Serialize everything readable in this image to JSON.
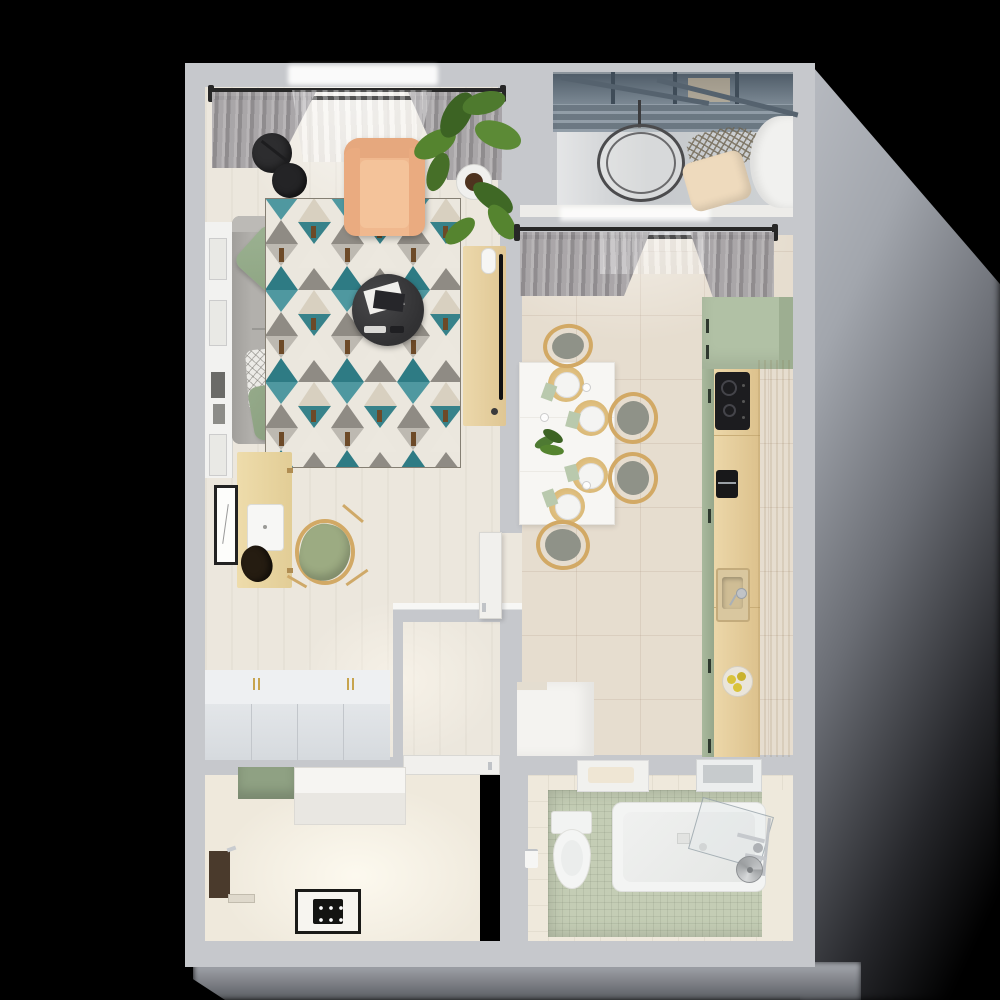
{
  "scene": {
    "title": "Top-down 3D render of a one-bedroom apartment floor plan",
    "view": "top-down interior render",
    "background_color": "#000000",
    "lighting": "daylight from upper-left; soft gray shadow cast to the right and below the outer walls"
  },
  "palette": {
    "bg": "#000000",
    "wall": "#c6c8cc",
    "rod": "#272727",
    "floorLiving": "#ece7dd",
    "floorKitchen": "#e6ddcf",
    "floorBalcony": "#ced1d4",
    "floorBath": "#c4cdb5",
    "bathWallTile": "#efe9dc",
    "floorDressing": "#efe9dc",
    "sofa": "#b2b0ac",
    "pillowGreen": "#8ea583",
    "pillowWhite": "#ecebe7",
    "seatBeige": "#e4dac6",
    "armchair": "#f0b88e",
    "rugBase": "#ebe7de",
    "rugTeal": "#4f98a0",
    "rugTealDark": "#2e7b84",
    "rugGray": "#8f8b84",
    "rugBrown": "#6d4a28",
    "tableBlack": "#3a3a3c",
    "plantGreen": "#55842f",
    "wood": "#e7d2a4",
    "woodDark": "#d8bd85",
    "chairGreen": "#9cab82",
    "diningTable": "#f7f6f3",
    "chairSeat": "#8f9288",
    "rattan": "#d2ae65",
    "napkin": "#b9c9ad",
    "kitchenGreen": "#b1c1a5",
    "cooktop": "#1c1c1f",
    "steel": "#55626e",
    "chrome": "#c0c3c7",
    "wardrobeTop": "#eef0f2",
    "wardrobeFront": "#dde1e5",
    "gold": "#c7a44e",
    "towelRail": "#4a3a2c",
    "doorWhite": "#f1f0ed"
  },
  "rooms": [
    {
      "id": "living-room",
      "label": "Living room",
      "floor": "light cream wood",
      "bbox": [
        205,
        85,
        295,
        535
      ]
    },
    {
      "id": "hallway",
      "label": "Hallway / corridor",
      "floor": "light cream wood",
      "bbox": [
        205,
        585,
        295,
        172
      ]
    },
    {
      "id": "balcony",
      "label": "Balcony",
      "floor": "gray concrete with glass balustrade",
      "bbox": [
        553,
        73,
        240,
        132
      ]
    },
    {
      "id": "kitchen",
      "label": "Kitchen and dining room",
      "floor": "beige ceramic tile",
      "bbox": [
        522,
        233,
        271,
        524
      ]
    },
    {
      "id": "bathroom",
      "label": "Bathroom",
      "floor": "sage green mosaic tile",
      "bbox": [
        522,
        775,
        271,
        168
      ]
    },
    {
      "id": "utility-room",
      "label": "Shower / utility room",
      "floor": "beige",
      "bbox": [
        205,
        775,
        275,
        168
      ]
    }
  ],
  "objects": {
    "living_room": [
      {
        "name": "curtain rod with gray curtains and sheer",
        "color": "#8b888b",
        "bbox": [
          211,
          87,
          292,
          90
        ]
      },
      {
        "name": "double-shade floor lamp",
        "color": "#2d2d2f",
        "bbox": [
          252,
          133,
          55,
          65
        ]
      },
      {
        "name": "white wall shelf with picture frames",
        "color": "#f2f2f0",
        "bbox": [
          205,
          222,
          27,
          256
        ]
      },
      {
        "name": "gray sofa",
        "color": "#b2b0ac",
        "bbox": [
          232,
          216,
          102,
          228
        ]
      },
      {
        "name": "sage green cushions (2)",
        "color": "#8ea583",
        "bbox": [
          243,
          233,
          55,
          205
        ]
      },
      {
        "name": "white diamond-pattern cushion",
        "color": "#ecebe7",
        "bbox": [
          247,
          349,
          38,
          62
        ]
      },
      {
        "name": "beige bench cushion",
        "color": "#e4dac6",
        "bbox": [
          270,
          416,
          64,
          28
        ]
      },
      {
        "name": "geometric rug teal/gray/cream",
        "color": "#4f98a0",
        "bbox": [
          265,
          198,
          196,
          270
        ]
      },
      {
        "name": "peach armchair",
        "color": "#f0b88e",
        "bbox": [
          344,
          138,
          81,
          98
        ]
      },
      {
        "name": "round black coffee table with magazines and remotes",
        "color": "#3a3a3c",
        "bbox": [
          352,
          274,
          72,
          72
        ]
      },
      {
        "name": "potted fiddle-leaf plant",
        "color": "#55842f",
        "bbox": [
          412,
          92,
          100,
          165
        ]
      },
      {
        "name": "light wood TV console",
        "color": "#e7d2a4",
        "bbox": [
          463,
          246,
          43,
          180
        ]
      },
      {
        "name": "flat TV seen edge-on",
        "color": "#101012",
        "bbox": [
          499,
          254,
          4,
          146
        ]
      },
      {
        "name": "white speaker",
        "color": "#f6f6f4",
        "bbox": [
          481,
          248,
          13,
          24
        ]
      },
      {
        "name": "light wood desk",
        "color": "#e7d2a4",
        "bbox": [
          237,
          452,
          55,
          136
        ]
      },
      {
        "name": "white closed laptop",
        "color": "#f7f7f5",
        "bbox": [
          247,
          504,
          35,
          45
        ]
      },
      {
        "name": "black bag on desk",
        "color": "#251c11",
        "bbox": [
          241,
          546,
          31,
          36
        ]
      },
      {
        "name": "sage desk chair with wood frame",
        "color": "#9cab82",
        "bbox": [
          295,
          519,
          60,
          66
        ]
      },
      {
        "name": "framed wall art",
        "color": "#222222",
        "bbox": [
          214,
          485,
          18,
          74
        ]
      },
      {
        "name": "open white interior door",
        "color": "#f1f0ed",
        "bbox": [
          479,
          532,
          21,
          85
        ]
      }
    ],
    "kitchen": [
      {
        "name": "curtain rod with gray curtains",
        "color": "#8b888b",
        "bbox": [
          517,
          226,
          258,
          78
        ]
      },
      {
        "name": "white dining table",
        "color": "#f7f6f3",
        "bbox": [
          519,
          362,
          94,
          161
        ]
      },
      {
        "name": "place settings with rattan mats, white plates, green napkins (4)",
        "color": "#d2ae65",
        "bbox": [
          547,
          365,
          60,
          140
        ]
      },
      {
        "name": "green plant centerpiece",
        "color": "#4e7a32",
        "bbox": [
          531,
          426,
          34,
          34
        ]
      },
      {
        "name": "wood dining chairs with gray-green seats (4)",
        "color": "#d2a965",
        "bbox": [
          536,
          324,
          122,
          246
        ]
      },
      {
        "name": "sage green tall cabinet",
        "color": "#b1c1a5",
        "bbox": [
          702,
          297,
          91,
          460
        ]
      },
      {
        "name": "light wood counter run",
        "color": "#e7d2a4",
        "bbox": [
          714,
          360,
          79,
          397
        ]
      },
      {
        "name": "black induction cooktop, 2 burners",
        "color": "#1c1c1f",
        "bbox": [
          715,
          372,
          35,
          58
        ]
      },
      {
        "name": "black coffee machine",
        "color": "#18181a",
        "bbox": [
          716,
          470,
          22,
          28
        ]
      },
      {
        "name": "inset sink with chrome faucet",
        "color": "#d9c79f",
        "bbox": [
          716,
          568,
          34,
          54
        ]
      },
      {
        "name": "fruit bowl with yellow fruit",
        "color": "#d9c33b",
        "bbox": [
          722,
          666,
          31,
          31
        ]
      },
      {
        "name": "white low cabinet block",
        "color": "#f4f3f0",
        "bbox": [
          517,
          682,
          77,
          74
        ]
      }
    ],
    "balcony": [
      {
        "name": "steel and glass balustrade",
        "color": "#55626e",
        "bbox": [
          553,
          72,
          240,
          60
        ]
      },
      {
        "name": "round hanging chair",
        "color": "#4b4b4d",
        "bbox": [
          597,
          124,
          88,
          78
        ]
      },
      {
        "name": "rope net hammock",
        "color": "#7a6f5e",
        "bbox": [
          688,
          128,
          74,
          40
        ]
      },
      {
        "name": "beige floor cushion",
        "color": "#eedabd",
        "bbox": [
          686,
          156,
          62,
          50
        ]
      },
      {
        "name": "curved white wall",
        "color": "#f1f1ef",
        "bbox": [
          750,
          116,
          43,
          92
        ]
      }
    ],
    "bathroom": [
      {
        "name": "white toilet with tank",
        "color": "#f4f5f4",
        "bbox": [
          551,
          811,
          39,
          76
        ]
      },
      {
        "name": "toilet paper holder",
        "color": "#f6f6f4",
        "bbox": [
          525,
          849,
          13,
          17
        ]
      },
      {
        "name": "white bathtub",
        "color": "#f3f4f3",
        "bbox": [
          612,
          802,
          152,
          88
        ]
      },
      {
        "name": "glass bath screen",
        "color": "#aab4ba",
        "bbox": [
          694,
          806,
          72,
          52
        ]
      },
      {
        "name": "chrome shower fixtures",
        "color": "#c0c3c7",
        "bbox": [
          737,
          818,
          34,
          60
        ]
      },
      {
        "name": "rolled gray towel",
        "color": "#9b9ea0",
        "bbox": [
          736,
          856,
          27,
          27
        ]
      },
      {
        "name": "white shelf with towel",
        "color": "#f1f1ee",
        "bbox": [
          577,
          760,
          70,
          30
        ]
      },
      {
        "name": "mirror cabinet",
        "color": "#eceeee",
        "bbox": [
          696,
          759,
          64,
          31
        ]
      },
      {
        "name": "white bathroom door",
        "color": "#f1f0ed",
        "bbox": [
          403,
          755,
          97,
          20
        ]
      }
    ],
    "utility_room": [
      {
        "name": "white wardrobe with gold handles",
        "color": "#eef0f2",
        "bbox": [
          205,
          670,
          185,
          90
        ]
      },
      {
        "name": "sage green cabinet",
        "color": "#8fa183",
        "bbox": [
          238,
          767,
          57,
          32
        ]
      },
      {
        "name": "white cabinet",
        "color": "#f1efeb",
        "bbox": [
          294,
          767,
          112,
          58
        ]
      },
      {
        "name": "dark wood towel rail with chrome hook",
        "color": "#4a3a2c",
        "bbox": [
          209,
          851,
          21,
          47
        ]
      },
      {
        "name": "threshold strip",
        "color": "#dfd9cc",
        "bbox": [
          228,
          894,
          27,
          9
        ]
      },
      {
        "name": "black and white shower drain plate",
        "color": "#1a1a18",
        "bbox": [
          295,
          889,
          66,
          45
        ]
      }
    ]
  }
}
